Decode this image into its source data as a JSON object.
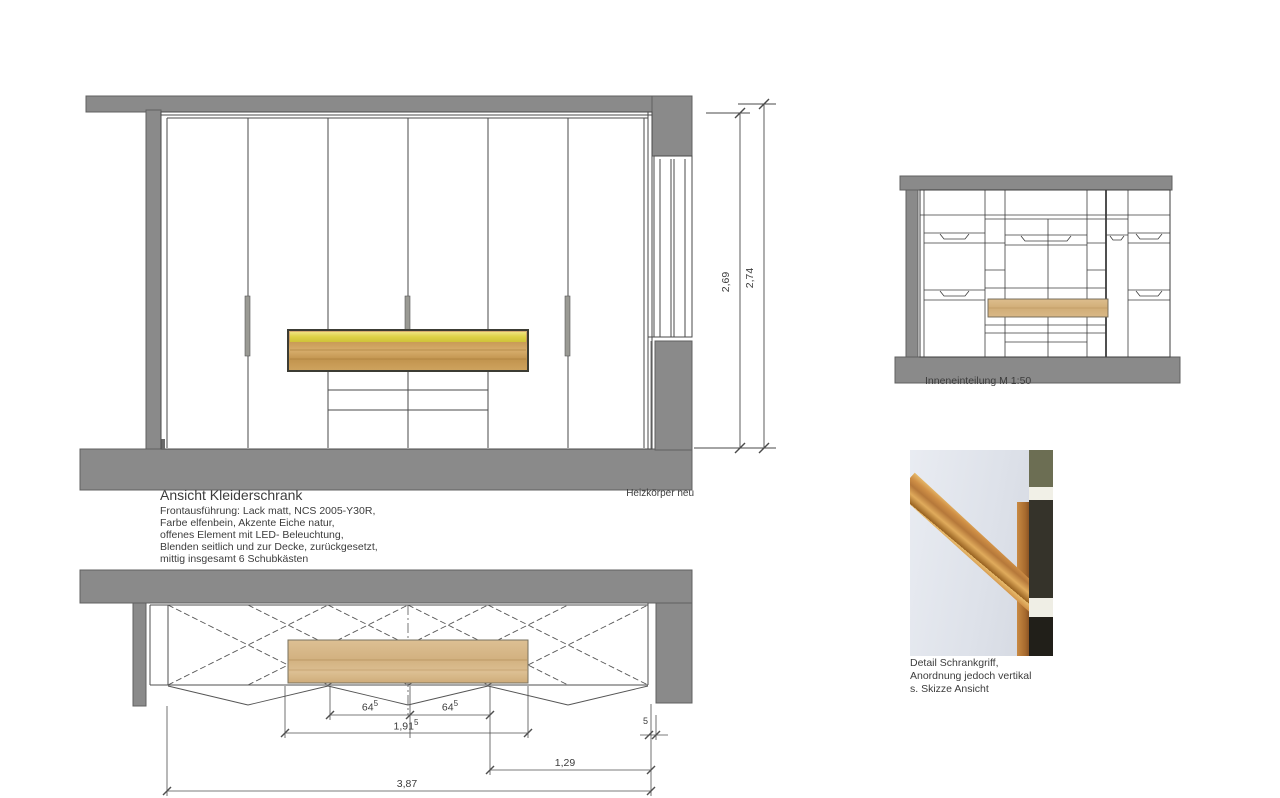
{
  "front_view": {
    "title": "Ansicht Kleiderschrank",
    "description_lines": [
      "Frontausführung: Lack matt, NCS 2005-Y30R,",
      "Farbe elfenbein, Akzente Eiche natur,",
      "offenes Element mit LED- Beleuchtung,",
      "Blenden seitlich und zur Decke, zurückgesetzt,",
      "mittig insgesamt 6 Schubkästen"
    ],
    "heater_label": "Heizkörper neu",
    "dim_inner_height": "2,69",
    "dim_total_height": "2,74"
  },
  "plan_view": {
    "dim_door_left": {
      "main": "64",
      "sup": "5"
    },
    "dim_door_right": {
      "main": "64",
      "sup": "5"
    },
    "dim_open_element": {
      "main": "1,91",
      "sup": "5"
    },
    "dim_right_section": "1,29",
    "dim_total_width": "3,87",
    "dim_side_gap": "5"
  },
  "interior_view": {
    "caption": "Inneneinteilung M 1:50"
  },
  "detail_photo": {
    "caption_lines": [
      "Detail Schrankgriff,",
      "Anordnung jedoch vertikal",
      "s. Skizze Ansicht"
    ]
  },
  "colors": {
    "wall_gray": "#8a8a8a",
    "drawing_line": "#474747",
    "oak_wood": "#cda25f",
    "led_yellow": "#ddd145",
    "plan_wood": "#d8ba8c",
    "photo_panel": "#e4e8ef",
    "photo_olive": "#6c6e53"
  }
}
